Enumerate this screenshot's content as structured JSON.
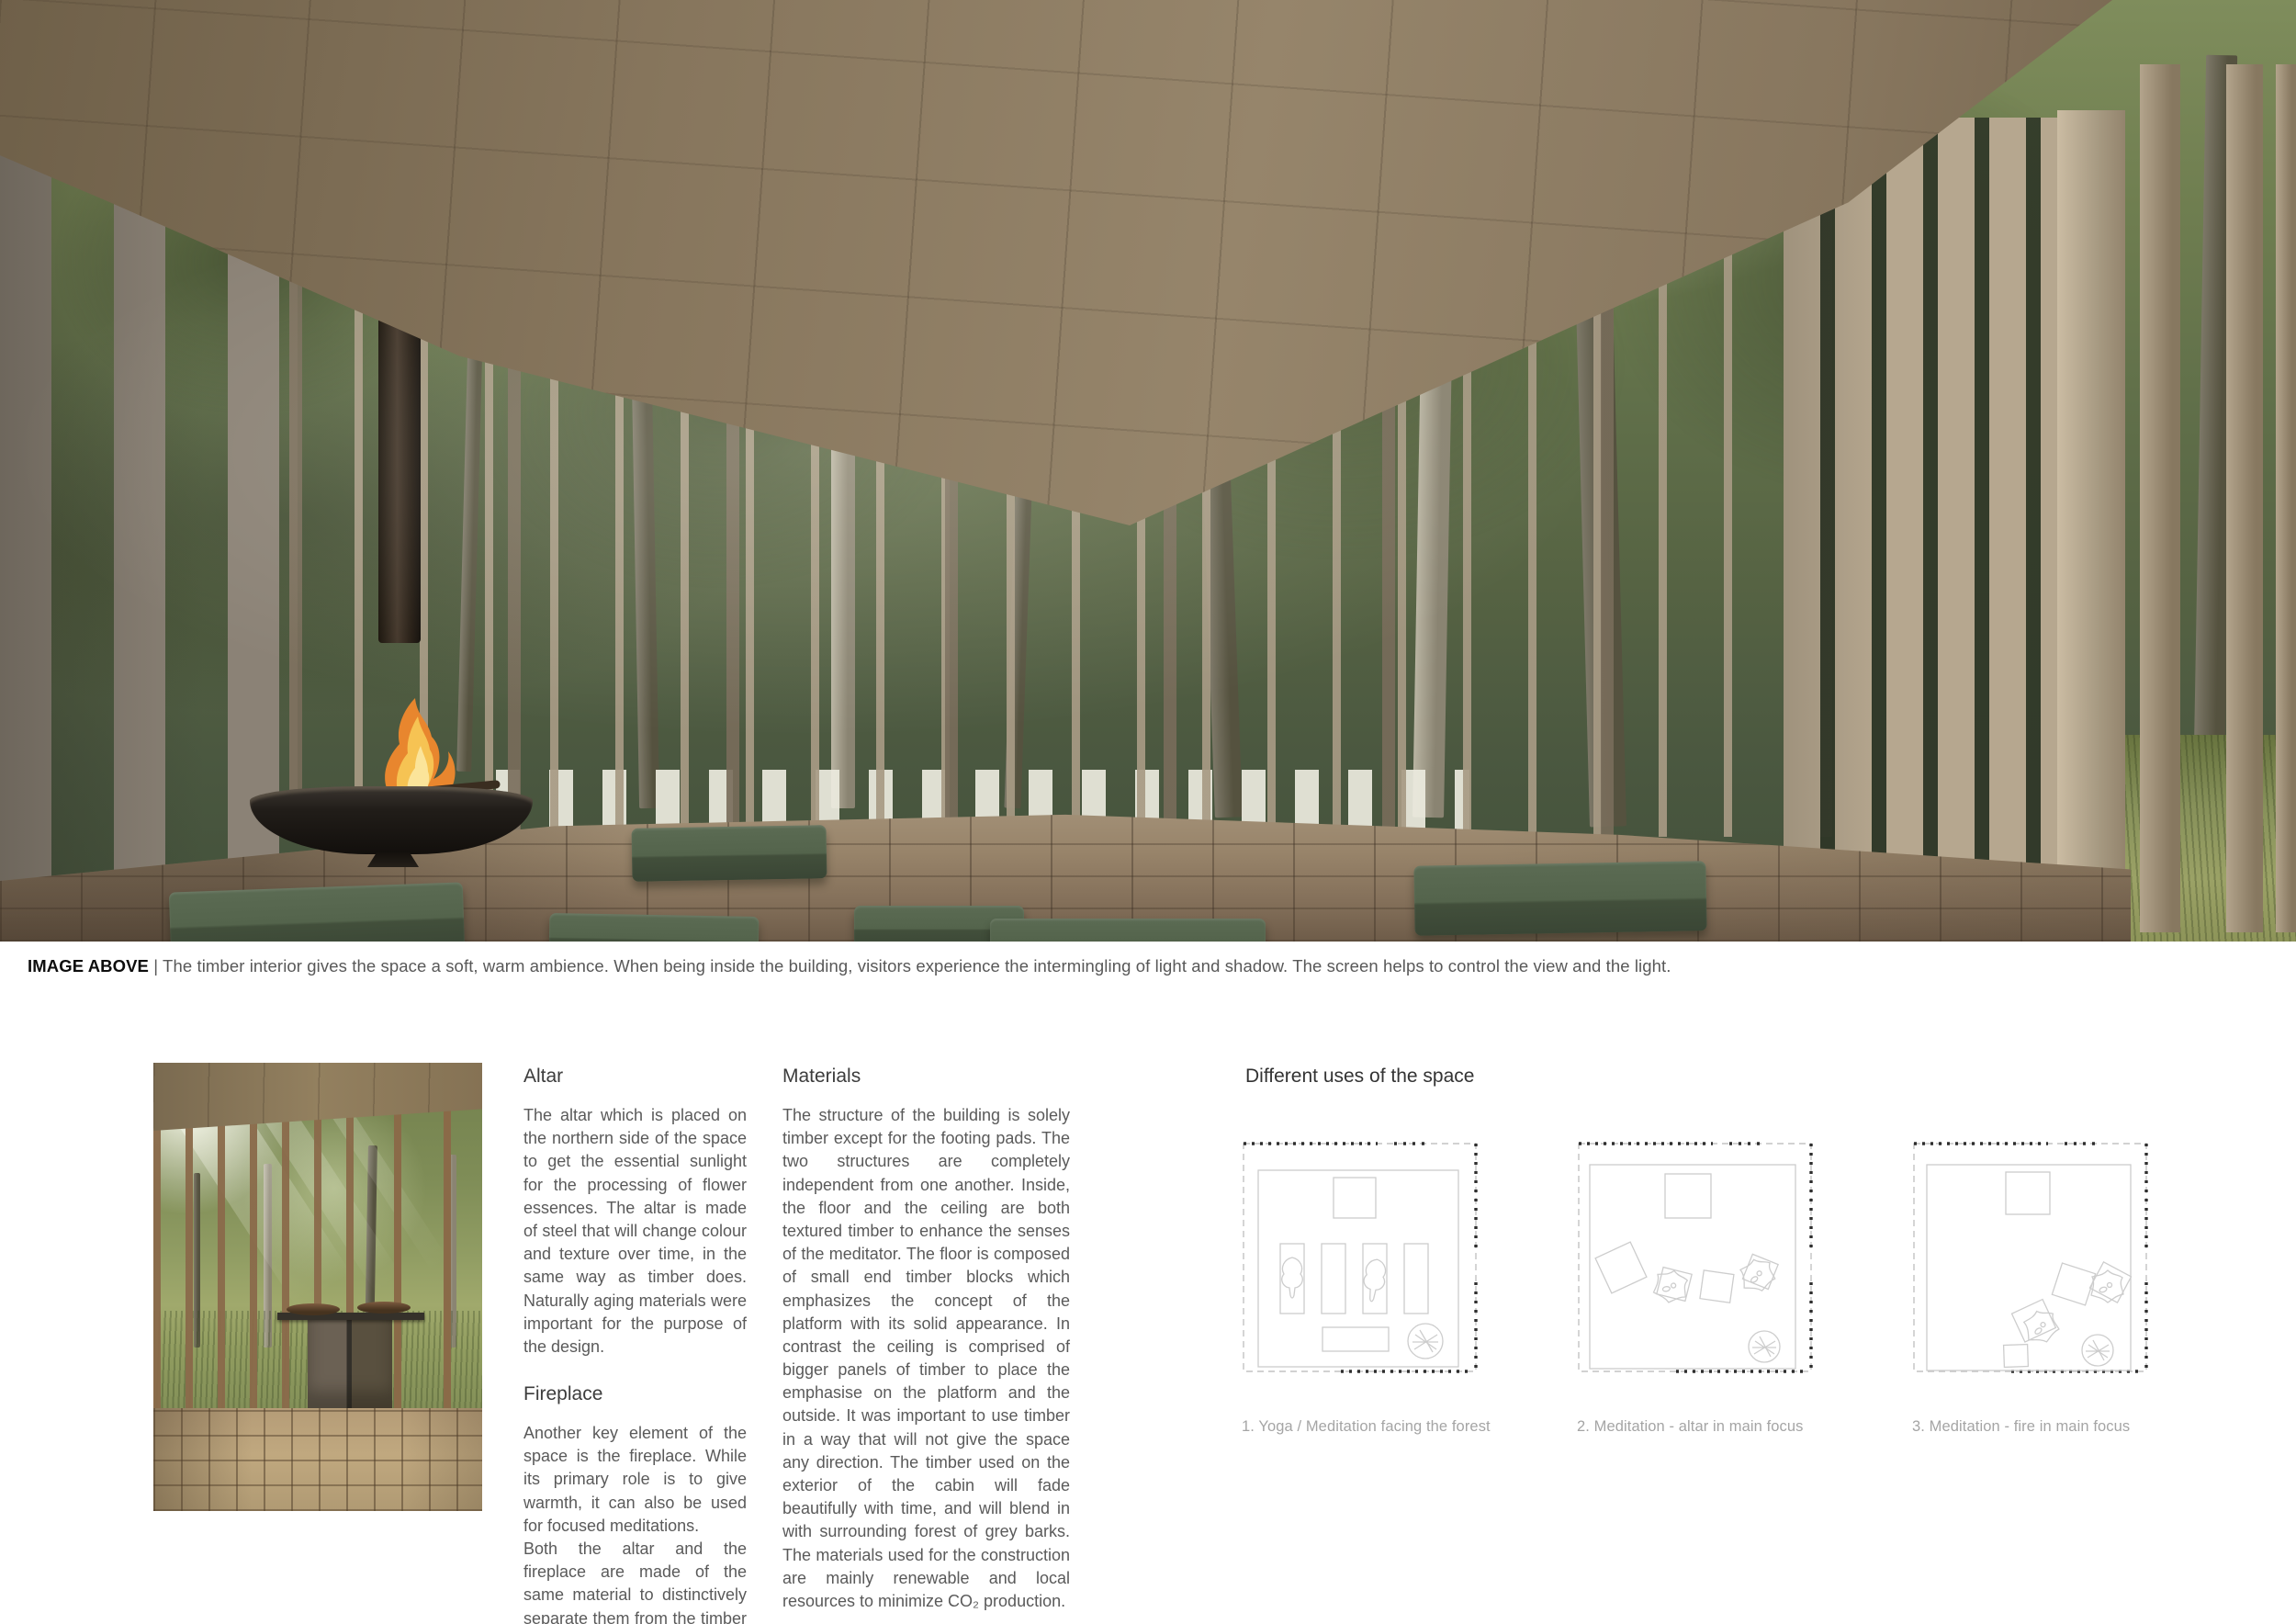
{
  "hero": {
    "caption_label": "IMAGE ABOVE",
    "caption_rest": "| The timber interior gives the space a soft, warm ambience. When being inside the building, visitors experience the intermingling of light and shadow. The screen helps to control the view and the light."
  },
  "columns": {
    "altar": {
      "heading": "Altar",
      "body": "The altar which is placed on the northern side of the space to get the essential sunlight for the processing of flower essences. The altar is made of steel that will change colour and texture over time, in the same way as timber does. Naturally aging materials were important for the purpose of the design."
    },
    "fireplace": {
      "heading": "Fireplace",
      "body1": "Another key element of the space is the fireplace. While its primary role is to give warmth, it can also be used for focused meditations.",
      "body2": "Both the altar and the fireplace are made of the same material to distinctively separate them from the timber elements."
    },
    "materials": {
      "heading": "Materials",
      "body": "The structure of the building is solely timber except for the footing pads. The two structures are completely independent from one another. Inside, the floor and the ceiling are both textured timber to enhance the senses of the meditator. The floor is composed of small end timber blocks which emphasizes the concept of the platform with its solid appearance. In contrast the ceiling is comprised of bigger panels of timber to place the emphasise on the platform and the outside.  It was important to use timber in a way that will not give the space any direction. The timber used on the exterior of the cabin will fade beautifully with time, and will blend in with surrounding forest of grey barks. The materials used for the construction are mainly renewable and local resources to minimize CO₂ production."
    }
  },
  "uses": {
    "heading": "Different uses of the space",
    "diagrams": [
      {
        "caption": "1. Yoga / Meditation facing the forest"
      },
      {
        "caption": "2. Meditation - altar in main focus"
      },
      {
        "caption": "3. Meditation - fire in main focus"
      }
    ]
  },
  "palette": {
    "ceiling_wood": "#8a7a62",
    "slat_grey": "#8b8276",
    "slat_light": "#b6a78f",
    "forest_green": "#5c6a45",
    "floor_tan": "#98846a",
    "cushion_green": "#4e5c48",
    "fire_orange": "#e8862e",
    "caption_grey": "#585858",
    "diagram_line": "#cdcdcd"
  }
}
